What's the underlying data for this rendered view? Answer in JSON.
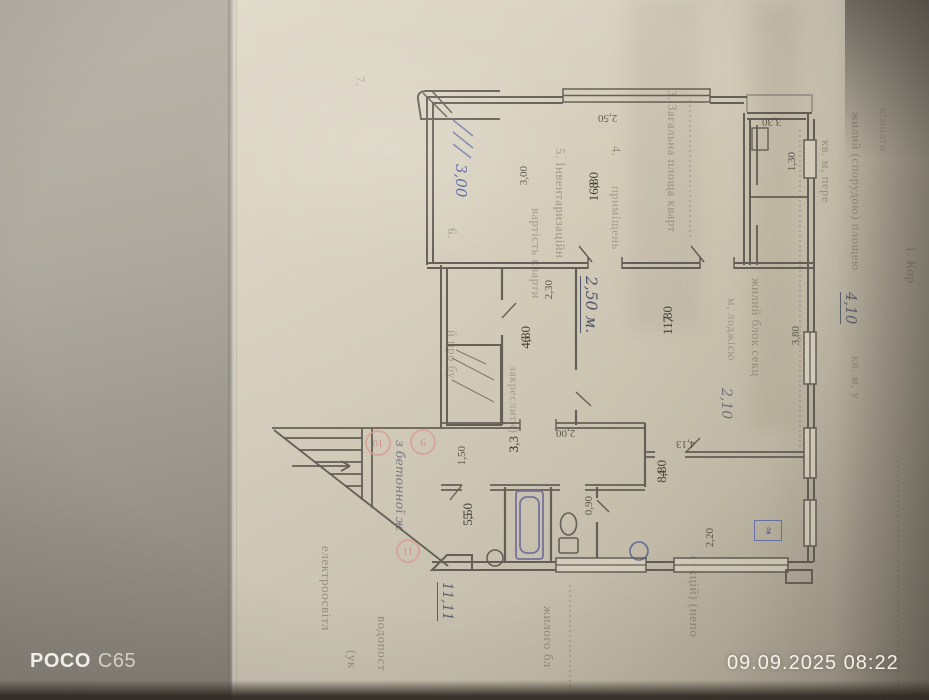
{
  "photo": {
    "camera_brand": "POCO",
    "camera_model": "C65",
    "timestamp": "09.09.2025  08:22"
  },
  "colors": {
    "paper": "#d7d0bd",
    "backdrop": "#a9a399",
    "plan_ink": "#56514a",
    "handwriting_ink": "#495066",
    "red_mark": "#cf8b84",
    "blue_ink": "#5a68aa",
    "watermark": "#faf9f5"
  },
  "document": {
    "form_columns": [
      {
        "text": "1. Кор",
        "x": 903,
        "y": 246,
        "s": 13,
        "o": 0.6
      },
      {
        "text": "кімнати",
        "x": 876,
        "y": 108,
        "s": 12,
        "o": 0.32
      },
      {
        "text": "жилий (спорудою) площею",
        "x": 848,
        "y": 112,
        "s": 12.5,
        "o": 0.5
      },
      {
        "text": "кв. м, у",
        "x": 848,
        "y": 356,
        "s": 12.5,
        "o": 0.45
      },
      {
        "text": "кв. м, пере",
        "x": 818,
        "y": 140,
        "s": 12.5,
        "o": 0.48
      },
      {
        "text": "жилий блок секц",
        "x": 748,
        "y": 278,
        "s": 12.5,
        "o": 0.5
      },
      {
        "text": "м, лоджією",
        "x": 724,
        "y": 298,
        "s": 12,
        "o": 0.45
      },
      {
        "text": "секцій) (непо",
        "x": 686,
        "y": 556,
        "s": 13,
        "o": 0.55
      },
      {
        "text": "3. Загальна площа кварт",
        "x": 664,
        "y": 90,
        "s": 12.5,
        "o": 0.5
      },
      {
        "text": "4.",
        "x": 608,
        "y": 146,
        "s": 12.5,
        "o": 0.5
      },
      {
        "text": "приміщень",
        "x": 608,
        "y": 186,
        "s": 12.5,
        "o": 0.42
      },
      {
        "text": "5. Інвентаризаційн",
        "x": 552,
        "y": 148,
        "s": 12.5,
        "o": 0.5
      },
      {
        "text": "вартість кварти",
        "x": 528,
        "y": 208,
        "s": 12.5,
        "o": 0.45
      },
      {
        "text": "закреслити)",
        "x": 506,
        "y": 366,
        "s": 12,
        "o": 0.45
      },
      {
        "text": "жилого бл",
        "x": 540,
        "y": 606,
        "s": 13,
        "o": 0.55
      },
      {
        "text": "6.",
        "x": 444,
        "y": 228,
        "s": 12.5,
        "o": 0.48
      },
      {
        "text": "й про бу",
        "x": 444,
        "y": 330,
        "s": 12.5,
        "o": 0.42
      },
      {
        "text": "7.",
        "x": 352,
        "y": 76,
        "s": 12.5,
        "o": 0.4
      },
      {
        "text": "водопост",
        "x": 374,
        "y": 616,
        "s": 13,
        "o": 0.55
      },
      {
        "text": "(ук",
        "x": 344,
        "y": 650,
        "s": 13,
        "o": 0.5
      },
      {
        "text": "електроосвітл",
        "x": 318,
        "y": 546,
        "s": 13,
        "o": 0.55
      }
    ],
    "handwriting": [
      {
        "text": "3,00",
        "x": 452,
        "y": 164,
        "s": 15,
        "ul": false,
        "ink": "blue",
        "o": 0.9
      },
      {
        "text": "2,50 м.",
        "x": 580,
        "y": 276,
        "s": 15.5,
        "ul": true,
        "ink": "dark",
        "o": 0.95
      },
      {
        "text": "4,10",
        "x": 840,
        "y": 292,
        "s": 14.5,
        "ul": true,
        "ink": "dark",
        "o": 0.85
      },
      {
        "text": "2,10",
        "x": 718,
        "y": 388,
        "s": 14,
        "ul": false,
        "ink": "dark",
        "o": 0.7
      },
      {
        "text": "11,11",
        "x": 437,
        "y": 582,
        "s": 13.5,
        "ul": true,
        "ink": "dark",
        "o": 0.85
      },
      {
        "text": "з бетонної ж",
        "x": 393,
        "y": 440,
        "s": 12.5,
        "ul": false,
        "ink": "dark",
        "o": 0.65
      }
    ]
  },
  "plan": {
    "room_labels": [
      {
        "num": "8",
        "area": "16,80",
        "x": 586,
        "y": 172
      },
      {
        "num": "7",
        "area": "11,80",
        "x": 660,
        "y": 306
      },
      {
        "num": "6",
        "area": "4,80",
        "x": 518,
        "y": 326
      },
      {
        "num": "3",
        "area": "3,3",
        "x": 506,
        "y": 436
      },
      {
        "num": "5",
        "area": "5,50",
        "x": 460,
        "y": 503
      },
      {
        "num": "4",
        "area": "8,80",
        "x": 654,
        "y": 460
      }
    ],
    "dimensions": [
      {
        "t": "2,50",
        "x": 598,
        "y": 112,
        "o": "h"
      },
      {
        "t": "3,30",
        "x": 762,
        "y": 116,
        "o": "h"
      },
      {
        "t": "1,30",
        "x": 786,
        "y": 152,
        "o": "v"
      },
      {
        "t": "3,00",
        "x": 518,
        "y": 166,
        "o": "v"
      },
      {
        "t": "2,30",
        "x": 543,
        "y": 280,
        "o": "v"
      },
      {
        "t": "3,80",
        "x": 790,
        "y": 326,
        "o": "v"
      },
      {
        "t": "4,13",
        "x": 676,
        "y": 438,
        "o": "h"
      },
      {
        "t": "2,00",
        "x": 556,
        "y": 427,
        "o": "h"
      },
      {
        "t": "1,50",
        "x": 456,
        "y": 446,
        "o": "v"
      },
      {
        "t": "0,90",
        "x": 583,
        "y": 496,
        "o": "v"
      },
      {
        "t": "2,20",
        "x": 704,
        "y": 528,
        "o": "v"
      }
    ],
    "red_marks": [
      {
        "text": "10",
        "x": 378,
        "y": 443
      },
      {
        "text": "9",
        "x": 423,
        "y": 442
      },
      {
        "text": "11",
        "x": 408,
        "y": 551
      }
    ],
    "blue_stamp": {
      "x": 754,
      "y": 520,
      "rows": [
        "4б",
        "4ж"
      ]
    }
  }
}
